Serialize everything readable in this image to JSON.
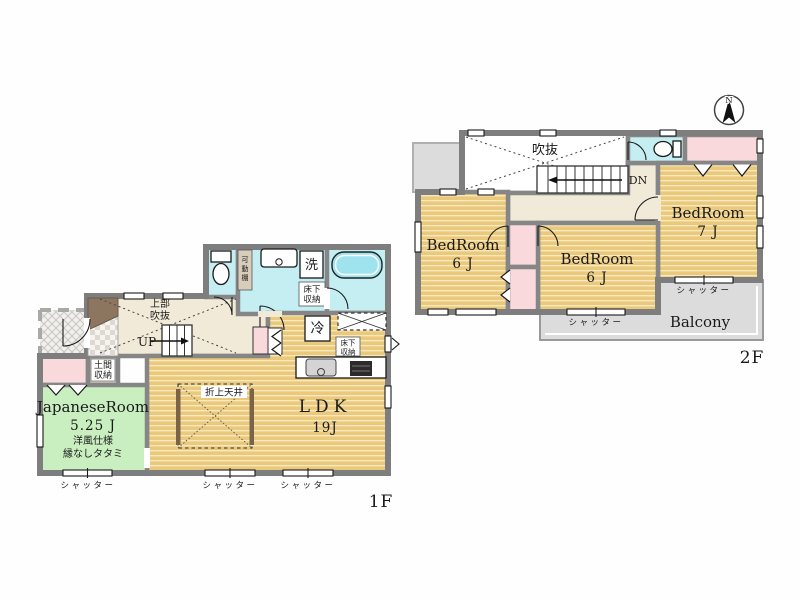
{
  "f1": {
    "label": "1F",
    "japanese_room": {
      "name": "JapaneseRoom",
      "size": "5.25 J",
      "spec": "洋風仕様",
      "tatami": "縁なしタタミ"
    },
    "ldk": {
      "name": "LDK",
      "size": "19J"
    },
    "raised_ceiling": "折上天井",
    "void_l1": "上部",
    "void_l2": "吹抜",
    "up": "UP",
    "doma_l1": "土間",
    "doma_l2": "収納",
    "washer": "洗",
    "fridge": "冷",
    "uf_wash_l1": "床下",
    "uf_wash_l2": "収納",
    "uf_kitchen_l1": "床下",
    "uf_kitchen_l2": "収納",
    "shelf_c0": "可",
    "shelf_c1": "動",
    "shelf_c2": "棚",
    "shutters": [
      "シャッター",
      "シャッター",
      "シャッター"
    ]
  },
  "f2": {
    "label": "2F",
    "void": "吹抜",
    "dn": "DN",
    "bedroom_left": {
      "name": "BedRoom",
      "size": "6 J"
    },
    "bedroom_center": {
      "name": "BedRoom",
      "size": "6 J"
    },
    "bedroom_right": {
      "name": "BedRoom",
      "size": "7 J"
    },
    "balcony": "Balcony",
    "shutters": [
      "シャッター",
      "シャッター"
    ]
  },
  "compass": {
    "north": "N"
  },
  "colors": {
    "wood_floor": "#eac87c",
    "wood_stripe": "#f8e9bd",
    "tatami_green": "#c9efc0",
    "water_cyan": "#c5eef2",
    "closet_pink": "#f9d9dc",
    "hall_beige": "#f2ead8",
    "balcony_gray": "#dcdcdc",
    "wall_gray": "#868686",
    "cabinet_brown": "#8d7660"
  }
}
